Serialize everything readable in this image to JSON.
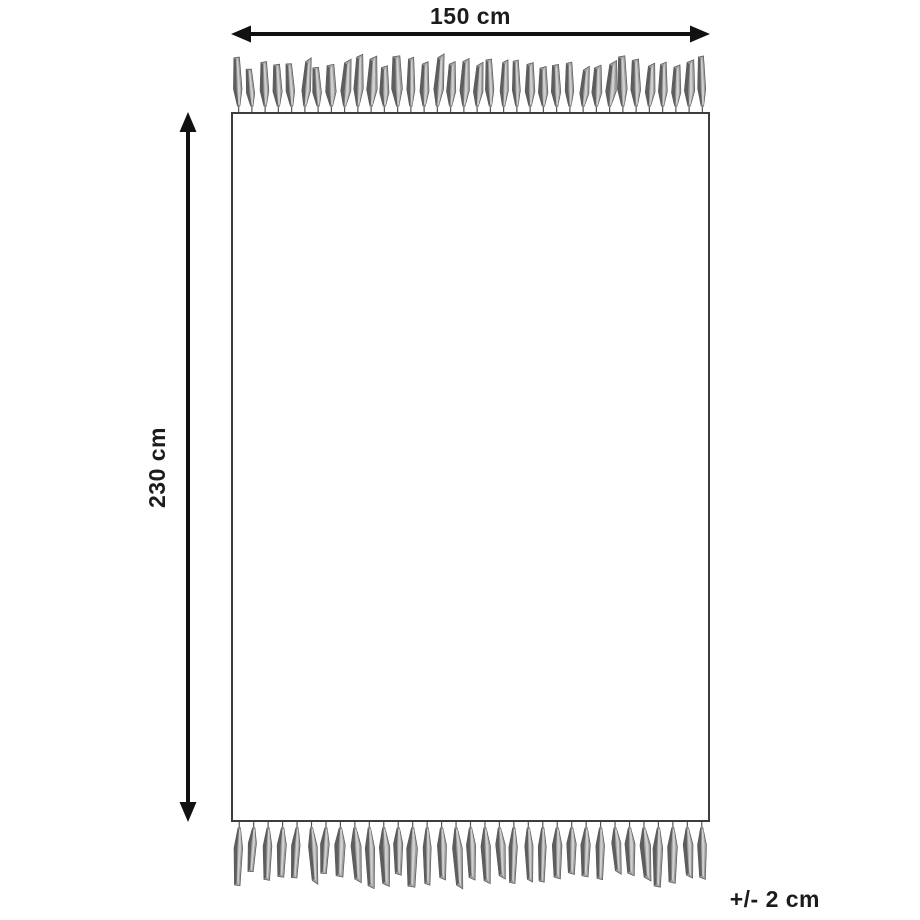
{
  "diagram": {
    "width_label": "150 cm",
    "height_label": "230 cm",
    "tolerance_label": "+/- 2 cm",
    "colors": {
      "background": "#ffffff",
      "arrow": "#111111",
      "text": "#1c1c1c",
      "rug_border": "#3d3d3d",
      "rug_fill": "#ffffff",
      "tassel_dark": "#5e5e5e",
      "tassel_mid": "#9b9b9b",
      "tassel_light": "#cfcfcf",
      "tassel_outline": "#4f4f4f",
      "tassel_string": "#555555"
    },
    "fringe": {
      "top_count": 36,
      "bottom_count": 33,
      "top_length": 44,
      "bottom_length": 52
    }
  }
}
